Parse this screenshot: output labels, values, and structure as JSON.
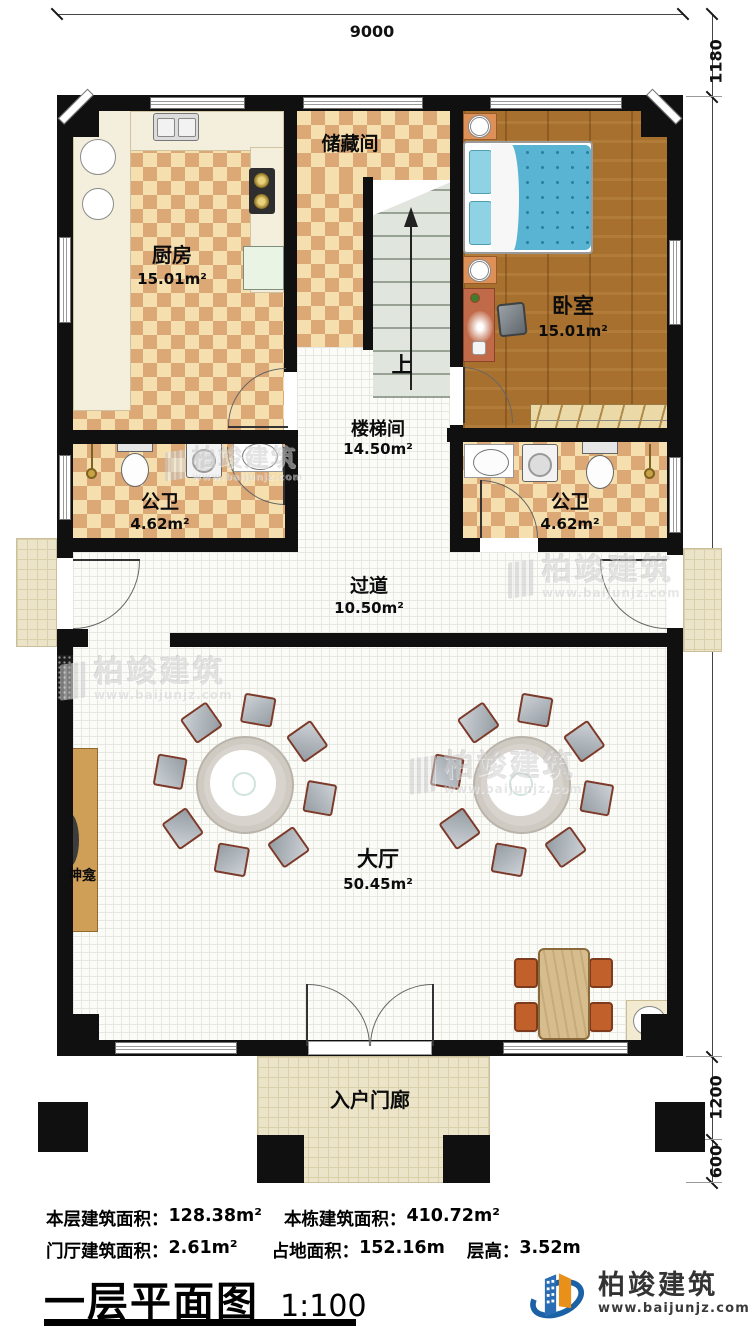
{
  "dimensions": {
    "top": "9000",
    "right": [
      "1180",
      "13800",
      "1200",
      "600"
    ]
  },
  "rooms": {
    "kitchen": {
      "name": "厨房",
      "area": "15.01m²"
    },
    "storage": {
      "name": "储藏间"
    },
    "bedroom": {
      "name": "卧室",
      "area": "15.01m²"
    },
    "stairwell": {
      "name": "楼梯间",
      "area": "14.50m²"
    },
    "bath_left": {
      "name": "公卫",
      "area": "4.62m²"
    },
    "bath_right": {
      "name": "公卫",
      "area": "4.62m²"
    },
    "corridor": {
      "name": "过道",
      "area": "10.50m²"
    },
    "hall": {
      "name": "大厅",
      "area": "50.45m²"
    },
    "porch": {
      "name": "入户门廊"
    },
    "shrine": {
      "name": "神龛"
    }
  },
  "stairs": {
    "up_label": "上"
  },
  "stats": {
    "floor_area_label": "本层建筑面积：",
    "floor_area": "128.38m²",
    "building_area_label": "本栋建筑面积：",
    "building_area": "410.72m²",
    "foyer_area_label": "门厅建筑面积：",
    "foyer_area": "2.61m²",
    "footprint_label": "占地面积：",
    "footprint": "152.16m",
    "height_label": "层高：",
    "height": "3.52m"
  },
  "title": {
    "text": "一层平面图",
    "scale": "1:100"
  },
  "brand": {
    "name": "柏竣建筑",
    "url": "www.baijunjz.com"
  },
  "watermark": {
    "name": "柏竣建筑",
    "url": "www.baijunjz.com"
  }
}
